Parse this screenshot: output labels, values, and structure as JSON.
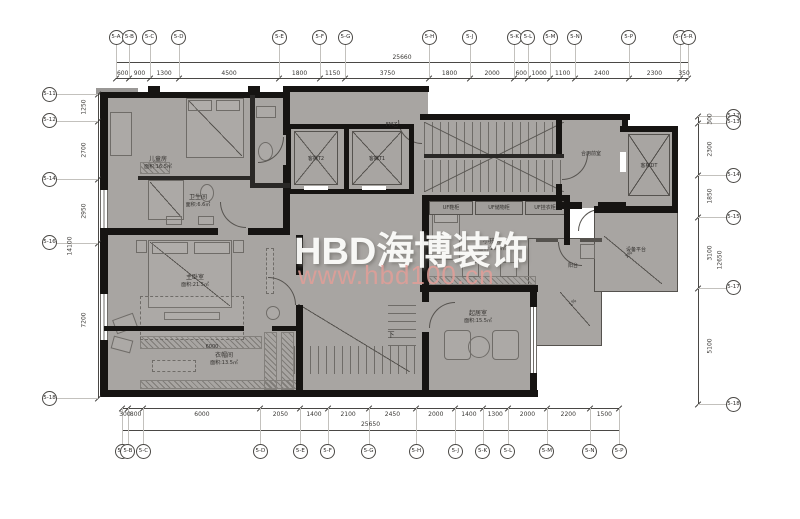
{
  "watermark": {
    "brand": "HBD海博装饰",
    "site": "www.hbd100.cn"
  },
  "colors": {
    "floor": "#a8a5a2",
    "wall": "#161412",
    "line": "#6f6c68",
    "watermark_brand": "#fdfdfb",
    "watermark_site": "#e29d98"
  },
  "axes": {
    "top": {
      "bubbles": [
        "5-A",
        "5-B",
        "5-C",
        "5-D",
        "5-E",
        "5-F",
        "5-G",
        "5-H",
        "5-J",
        "5-K",
        "5-L",
        "5-M",
        "5-N",
        "5-P",
        "5-Q",
        "5-R"
      ],
      "dims": [
        "600",
        "900",
        "1300",
        "4500",
        "1800",
        "1150",
        "3750",
        "1800",
        "2000",
        "600",
        "1000",
        "1100",
        "2400",
        "2300",
        "350"
      ],
      "total": "25660"
    },
    "bottom": {
      "bubbles": [
        "5-A",
        "5-B",
        "5-C",
        "5-D",
        "5-E",
        "5-F",
        "5-G",
        "5-H",
        "5-J",
        "5-K",
        "5-L",
        "5-M",
        "5-N",
        "5-P"
      ],
      "dims": [
        "300",
        "800",
        "6000",
        "2050",
        "1400",
        "2100",
        "2450",
        "2000",
        "1400",
        "1300",
        "2000",
        "2200",
        "1500"
      ],
      "total": "25650"
    },
    "left": {
      "bubbles": [
        "5-11",
        "5-12",
        "5-14",
        "5-16",
        "5-18"
      ],
      "dims": [
        "1250",
        "2700",
        "2950",
        "7200"
      ],
      "total": "14100"
    },
    "right": {
      "bubbles": [
        "5-12",
        "5-13",
        "5-14",
        "5-15",
        "5-17",
        "5-18"
      ],
      "dims": [
        "300",
        "2300",
        "1850",
        "3100",
        "5100"
      ],
      "total": "12650"
    }
  },
  "rooms": {
    "children": {
      "label": "儿童房",
      "area": "面积:16.5㎡"
    },
    "bathroom": {
      "label": "卫生间",
      "area": "面积:6.6㎡"
    },
    "master": {
      "label": "主卧室",
      "area": "面积:21.5㎡"
    },
    "cloak": {
      "label": "衣帽间",
      "area": "面积:13.5㎡"
    },
    "kids": {
      "label": "小孩房",
      "area": "面积:15.5㎡"
    },
    "sitting": {
      "label": "起居室",
      "area": "面积:15.5㎡"
    },
    "lobby": {
      "label": "合用前室"
    },
    "equipment": {
      "label": "设备平台"
    },
    "balcony": {
      "label": "阳台"
    }
  },
  "elevators": {
    "left": "客梯T2",
    "right": "客梯T1",
    "service": "客梯DT"
  },
  "annotations": {
    "fire_door": "FM乙",
    "stair_down": "下",
    "slope": "1%",
    "inner_dim": "6000",
    "cabinets": [
      "UF鞋柜",
      "UF储物柜",
      "UF挂衣柜"
    ]
  }
}
